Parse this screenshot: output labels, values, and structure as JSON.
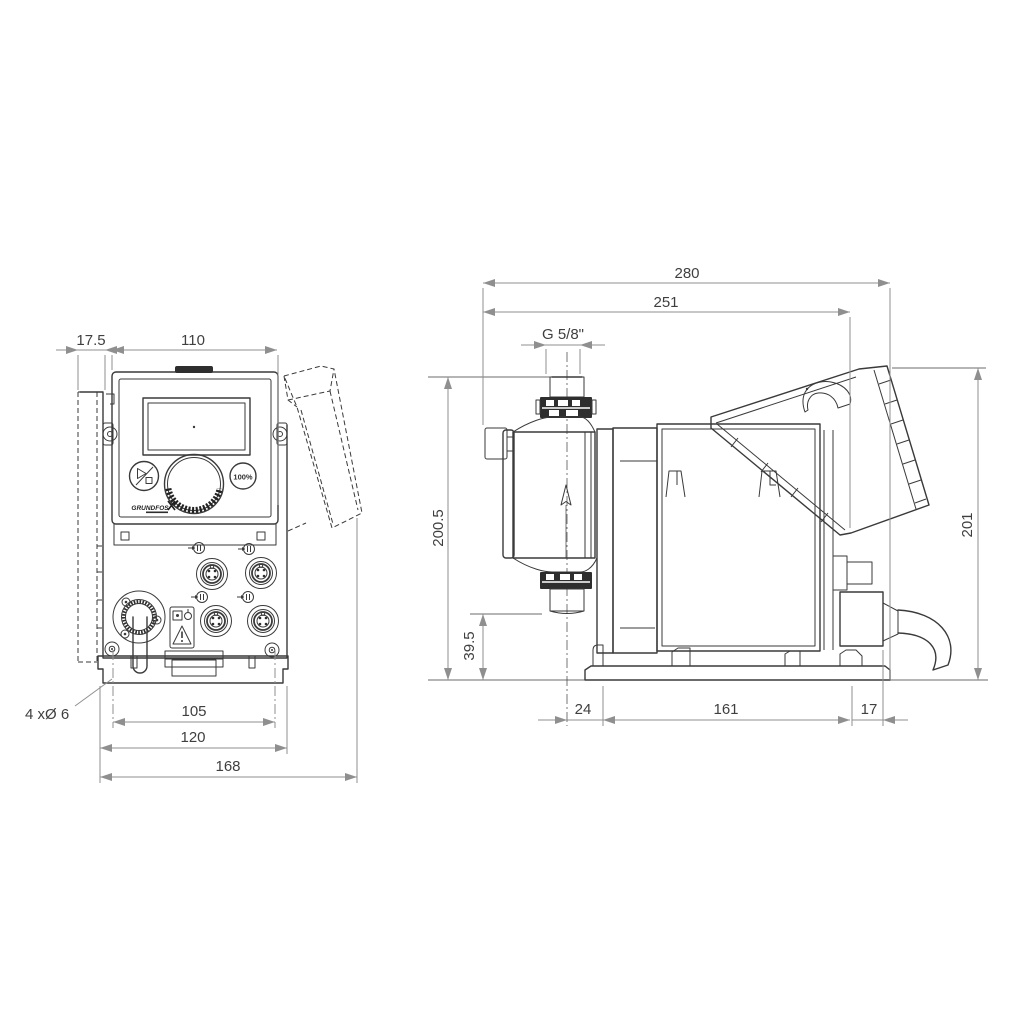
{
  "drawing": {
    "background": "#ffffff",
    "line_color": "#3a3a3a",
    "dim_color": "#8f8f8f"
  },
  "front_view": {
    "dim_offset_depth": "17.5",
    "dim_panel_width": "110",
    "dim_hole_spacing": "105",
    "dim_plate_width": "120",
    "dim_overall_width": "168",
    "note_mounting_holes": "4 xØ 6",
    "button_full_speed": "100%",
    "logo": "GRUNDFOS"
  },
  "side_view": {
    "dim_overall_depth": "280",
    "dim_depth_to_hood": "251",
    "dim_connection_thread": "G 5/8\"",
    "dim_height_to_connection": "200.5",
    "dim_valve_bottom_height": "39.5",
    "dim_overall_height": "201",
    "dim_foot_front_offset": "24",
    "dim_foot_length": "161",
    "dim_foot_rear_offset": "17"
  }
}
